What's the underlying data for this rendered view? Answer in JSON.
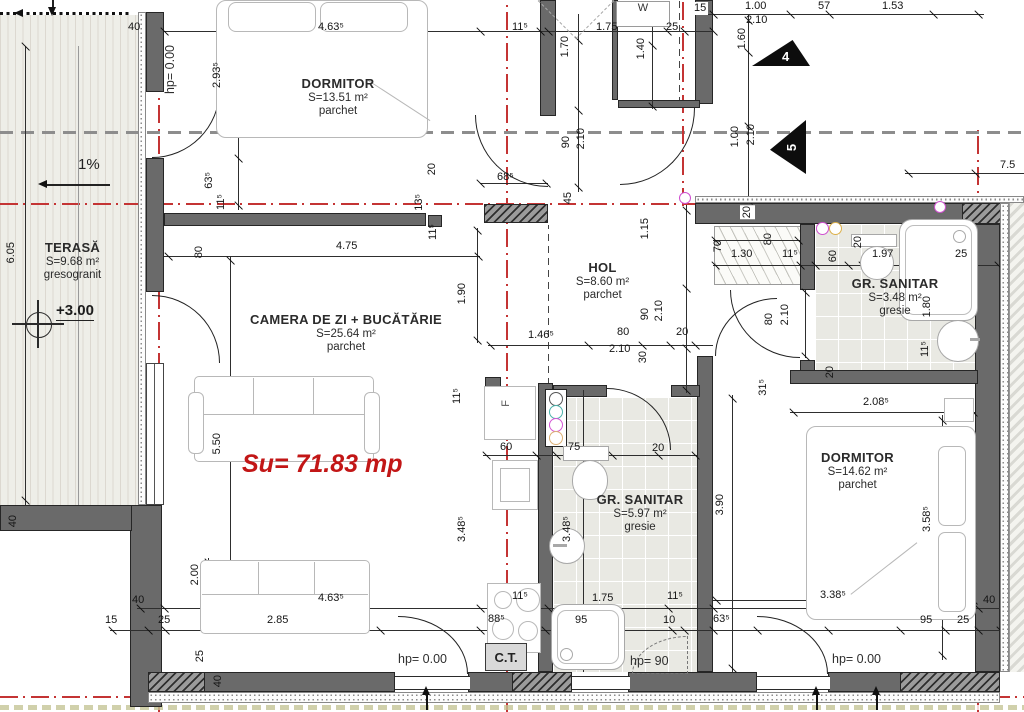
{
  "rooms": [
    {
      "id": "dormitor-top",
      "name": "DORMITOR",
      "area": "S=13.51 m²",
      "finish": "parchet"
    },
    {
      "id": "camera-de-zi",
      "name": "CAMERA DE ZI + BUCĂTĂRIE",
      "area": "S=25.64 m²",
      "finish": "parchet"
    },
    {
      "id": "hol",
      "name": "HOL",
      "area": "S=8.60 m²",
      "finish": "parchet"
    },
    {
      "id": "gr-sanitar-mic",
      "name": "GR. SANITAR",
      "area": "S=3.48 m²",
      "finish": "gresie"
    },
    {
      "id": "gr-sanitar-mare",
      "name": "GR. SANITAR",
      "area": "S=5.97 m²",
      "finish": "gresie"
    },
    {
      "id": "dormitor-dreapta",
      "name": "DORMITOR",
      "area": "S=14.62 m²",
      "finish": "parchet"
    },
    {
      "id": "terasa",
      "name": "TERASĂ",
      "area": "S=9.68 m²",
      "finish": "gresogranit"
    }
  ],
  "annotations": {
    "su_total": "Su= 71.83 mp",
    "level": "+3.00",
    "slope": "1%",
    "boiler": "C.T.",
    "fridge": "F",
    "washer": "W",
    "hp_left_wall": "hp= 0.00",
    "hp_bottom_left": "hp= 0.00",
    "hp_bottom_mid": "hp= 90",
    "hp_bottom_right": "hp= 0.00",
    "marker_4": "4",
    "marker_5": "5"
  },
  "dimensions": [
    {
      "t": "40",
      "x": 128,
      "y": 22
    },
    {
      "t": "4.63⁵",
      "x": 318,
      "y": 22
    },
    {
      "t": "11⁵",
      "x": 512,
      "y": 22
    },
    {
      "t": "1.75",
      "x": 596,
      "y": 22
    },
    {
      "t": "25",
      "x": 666,
      "y": 22
    },
    {
      "t": "15",
      "x": 692,
      "y": 2,
      "chip": true
    },
    {
      "t": "1.00",
      "x": 745,
      "y": 1
    },
    {
      "t": "57",
      "x": 818,
      "y": 1
    },
    {
      "t": "1.53",
      "x": 882,
      "y": 1
    },
    {
      "t": "2.10",
      "x": 746,
      "y": 15
    },
    {
      "t": "1.60",
      "x": 737,
      "y": 28,
      "r": true
    },
    {
      "t": "1.70",
      "x": 560,
      "y": 36,
      "r": true
    },
    {
      "t": "1.40",
      "x": 636,
      "y": 38,
      "r": true
    },
    {
      "t": "2.93⁵",
      "x": 212,
      "y": 62,
      "r": true
    },
    {
      "t": "90",
      "x": 561,
      "y": 136,
      "r": true
    },
    {
      "t": "2.10",
      "x": 576,
      "y": 128,
      "r": true
    },
    {
      "t": "1.00",
      "x": 730,
      "y": 126,
      "r": true
    },
    {
      "t": "2.10",
      "x": 746,
      "y": 124,
      "r": true
    },
    {
      "t": "63⁵",
      "x": 204,
      "y": 172,
      "r": true
    },
    {
      "t": "11⁵",
      "x": 216,
      "y": 194,
      "r": true
    },
    {
      "t": "20",
      "x": 427,
      "y": 163,
      "r": true
    },
    {
      "t": "68⁵",
      "x": 497,
      "y": 172
    },
    {
      "t": "13⁵",
      "x": 414,
      "y": 194,
      "r": true
    },
    {
      "t": "45",
      "x": 563,
      "y": 192,
      "r": true
    },
    {
      "t": "20",
      "x": 740,
      "y": 205,
      "r": true,
      "chip": true
    },
    {
      "t": "4.75",
      "x": 336,
      "y": 241
    },
    {
      "t": "80",
      "x": 194,
      "y": 246,
      "r": true
    },
    {
      "t": "6.05",
      "x": 6,
      "y": 242,
      "r": true
    },
    {
      "t": "1.15",
      "x": 640,
      "y": 218,
      "r": true
    },
    {
      "t": "70",
      "x": 713,
      "y": 240,
      "r": true
    },
    {
      "t": "1.30",
      "x": 731,
      "y": 249
    },
    {
      "t": "80",
      "x": 763,
      "y": 233,
      "r": true
    },
    {
      "t": "11⁵",
      "x": 782,
      "y": 249
    },
    {
      "t": "60",
      "x": 828,
      "y": 250,
      "r": true
    },
    {
      "t": "20",
      "x": 853,
      "y": 236,
      "r": true
    },
    {
      "t": "1.97",
      "x": 872,
      "y": 249
    },
    {
      "t": "25",
      "x": 955,
      "y": 249
    },
    {
      "t": "80",
      "x": 764,
      "y": 313,
      "r": true
    },
    {
      "t": "2.10",
      "x": 780,
      "y": 304,
      "r": true
    },
    {
      "t": "1.80",
      "x": 922,
      "y": 296,
      "r": true
    },
    {
      "t": "11⁵",
      "x": 920,
      "y": 341,
      "r": true
    },
    {
      "t": "20",
      "x": 825,
      "y": 366,
      "r": true
    },
    {
      "t": "31⁵",
      "x": 758,
      "y": 379,
      "r": true
    },
    {
      "t": "7.5",
      "x": 1000,
      "y": 160
    },
    {
      "t": "1.90",
      "x": 457,
      "y": 283,
      "r": true
    },
    {
      "t": "11⁵",
      "x": 428,
      "y": 224,
      "r": true
    },
    {
      "t": "1.46⁵",
      "x": 528,
      "y": 330
    },
    {
      "t": "80",
      "x": 617,
      "y": 327
    },
    {
      "t": "2.10",
      "x": 609,
      "y": 344
    },
    {
      "t": "20",
      "x": 676,
      "y": 327
    },
    {
      "t": "90",
      "x": 640,
      "y": 308,
      "r": true
    },
    {
      "t": "2.10",
      "x": 654,
      "y": 300,
      "r": true
    },
    {
      "t": "30",
      "x": 638,
      "y": 351,
      "r": true
    },
    {
      "t": "11⁵",
      "x": 452,
      "y": 388,
      "r": true
    },
    {
      "t": "5.50",
      "x": 212,
      "y": 433,
      "r": true
    },
    {
      "t": "2.08⁵",
      "x": 863,
      "y": 397
    },
    {
      "t": "3.90",
      "x": 715,
      "y": 494,
      "r": true
    },
    {
      "t": "3.58⁵",
      "x": 922,
      "y": 506,
      "r": true
    },
    {
      "t": "60",
      "x": 500,
      "y": 442
    },
    {
      "t": "75",
      "x": 568,
      "y": 442
    },
    {
      "t": "20",
      "x": 652,
      "y": 443
    },
    {
      "t": "3.48⁵",
      "x": 457,
      "y": 516,
      "r": true
    },
    {
      "t": "3.48⁵",
      "x": 562,
      "y": 516,
      "r": true
    },
    {
      "t": "11⁵",
      "x": 512,
      "y": 591
    },
    {
      "t": "1.75",
      "x": 592,
      "y": 593
    },
    {
      "t": "11⁵",
      "x": 667,
      "y": 591
    },
    {
      "t": "88⁵",
      "x": 488,
      "y": 614
    },
    {
      "t": "95",
      "x": 575,
      "y": 615
    },
    {
      "t": "10",
      "x": 663,
      "y": 615
    },
    {
      "t": "63⁵",
      "x": 713,
      "y": 614
    },
    {
      "t": "3.38⁵",
      "x": 820,
      "y": 590
    },
    {
      "t": "40",
      "x": 983,
      "y": 595
    },
    {
      "t": "95",
      "x": 920,
      "y": 615
    },
    {
      "t": "25",
      "x": 957,
      "y": 615
    },
    {
      "t": "40",
      "x": 132,
      "y": 595
    },
    {
      "t": "15",
      "x": 105,
      "y": 615
    },
    {
      "t": "25",
      "x": 158,
      "y": 615
    },
    {
      "t": "2.85",
      "x": 267,
      "y": 615
    },
    {
      "t": "4.63⁵",
      "x": 318,
      "y": 593
    },
    {
      "t": "2.00",
      "x": 190,
      "y": 564,
      "r": true
    },
    {
      "t": "25",
      "x": 195,
      "y": 650,
      "r": true
    },
    {
      "t": "40",
      "x": 213,
      "y": 675,
      "r": true
    },
    {
      "t": "40",
      "x": 8,
      "y": 515,
      "r": true
    }
  ],
  "colors": {
    "axis_red": "#c43434",
    "total_red": "#c21616",
    "wall_gray": "#6a6a6a",
    "tile_gray": "#e9e9e3"
  }
}
